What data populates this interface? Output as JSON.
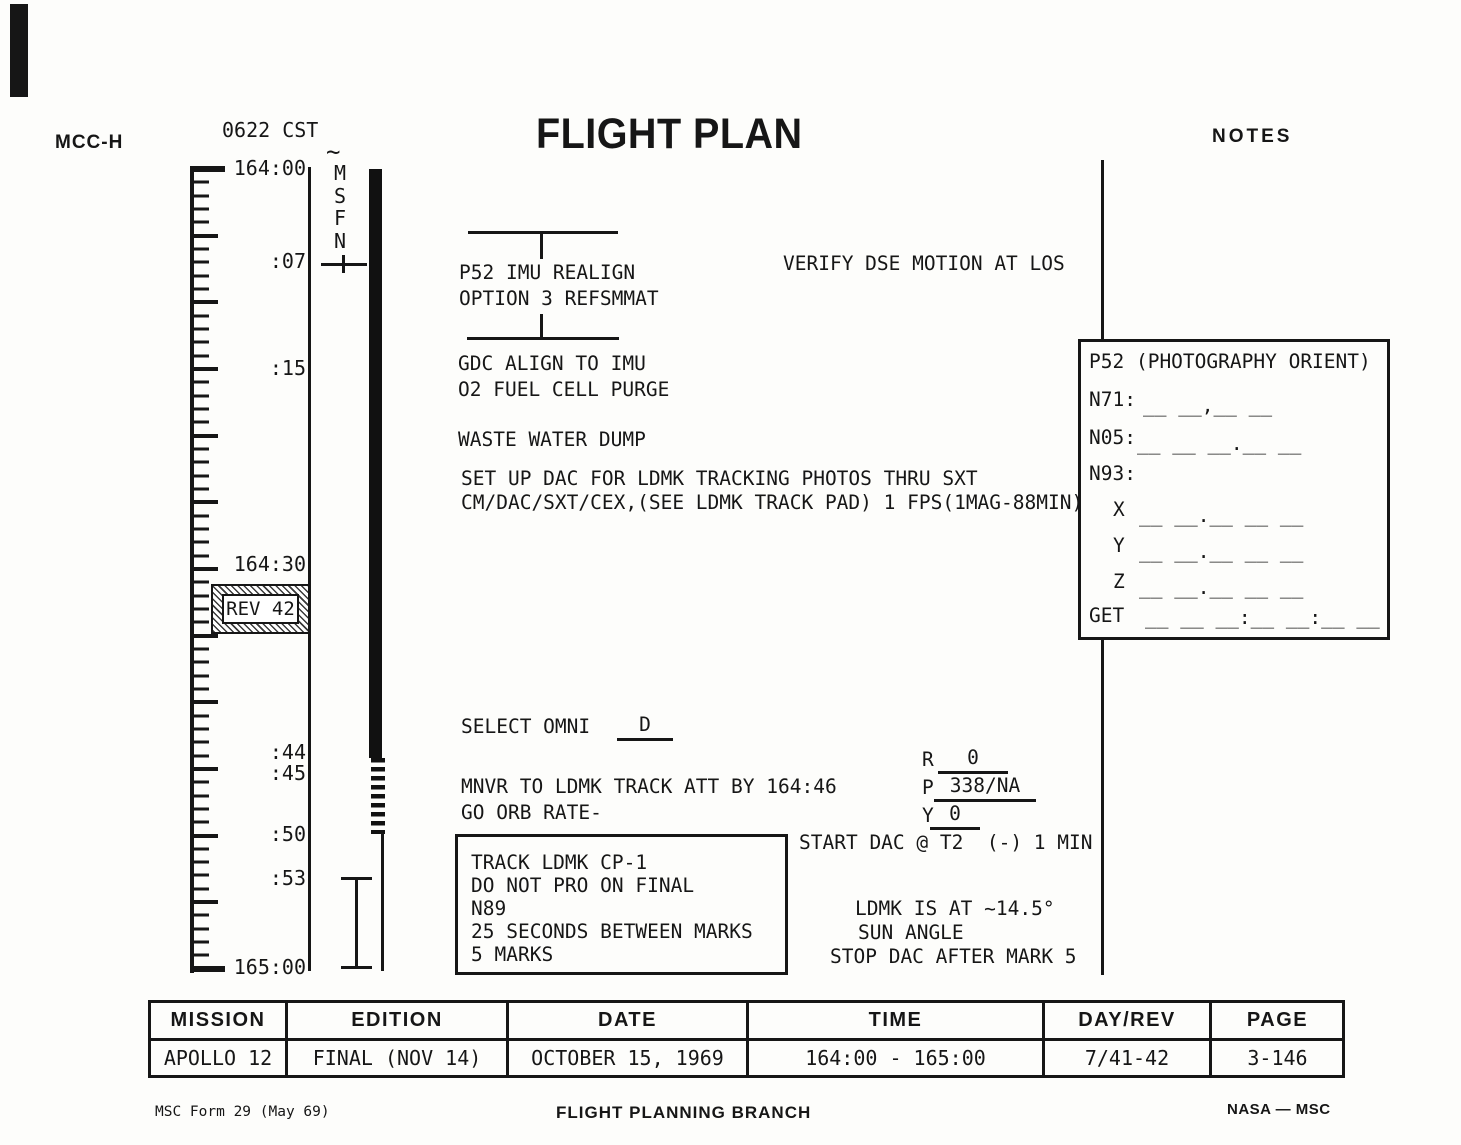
{
  "header": {
    "station": "MCC-H",
    "cst": "0622 CST",
    "title": "FLIGHT PLAN",
    "notes_label": "NOTES"
  },
  "timeline": {
    "start": "164:00",
    "end": "165:00",
    "marks": [
      {
        "label": ":07"
      },
      {
        "label": ":15"
      },
      {
        "label": "164:30"
      },
      {
        "label": ":44"
      },
      {
        "label": ":45"
      },
      {
        "label": ":50"
      },
      {
        "label": ":53"
      }
    ],
    "rev": "REV 42",
    "msfn": "M\nS\nF\nN",
    "tilde": "~"
  },
  "flightplan": {
    "p52_line1": "P52 IMU REALIGN",
    "p52_line2": "OPTION 3 REFSMMAT",
    "gdc": "GDC ALIGN TO IMU",
    "o2": "O2 FUEL CELL PURGE",
    "waste": "WASTE WATER DUMP",
    "dac1": "SET UP DAC FOR LDMK TRACKING PHOTOS THRU SXT",
    "dac2": "CM/DAC/SXT/CEX,(SEE LDMK TRACK PAD) 1 FPS(1MAG-88MIN)",
    "select_omni": "SELECT OMNI",
    "omni_value": "D",
    "mnvr": "MNVR TO LDMK TRACK ATT BY 164:46",
    "go_orb": "GO ORB RATE-",
    "att": [
      {
        "axis": "R",
        "value": "0"
      },
      {
        "axis": "P",
        "value": "338/NA"
      },
      {
        "axis": "Y",
        "value": "0"
      }
    ],
    "track_box": [
      {
        "line": "TRACK LDMK CP-1"
      },
      {
        "line": "DO NOT PRO ON FINAL"
      },
      {
        "line": "N89"
      },
      {
        "line": "25 SECONDS BETWEEN MARKS"
      },
      {
        "line": "5 MARKS"
      }
    ]
  },
  "notes": {
    "verify": "VERIFY DSE MOTION AT LOS",
    "p52_box": {
      "title": "P52 (PHOTOGRAPHY ORIENT)",
      "rows": [
        {
          "label": "N71:",
          "blank": "__ __,__ __"
        },
        {
          "label": "N05:",
          "blank": "__ __ __.__ __"
        },
        {
          "label": "N93:",
          "blank": ""
        },
        {
          "label": "X",
          "blank": "__ __.__ __ __"
        },
        {
          "label": "Y",
          "blank": "__ __.__ __ __"
        },
        {
          "label": "Z",
          "blank": "__ __.__ __ __"
        },
        {
          "label": "GET",
          "blank": "__ __ __:__ __:__ __"
        }
      ]
    },
    "start_dac": "START DAC @ T2  (-) 1 MIN",
    "ldmk1": "LDMK IS AT ~14.5°",
    "ldmk2": "SUN ANGLE",
    "stop_dac": "STOP DAC AFTER MARK 5"
  },
  "footer_table": {
    "columns": [
      {
        "header": "MISSION",
        "value": "APOLLO 12"
      },
      {
        "header": "EDITION",
        "value": "FINAL (NOV 14)"
      },
      {
        "header": "DATE",
        "value": "OCTOBER 15, 1969"
      },
      {
        "header": "TIME",
        "value": "164:00 - 165:00"
      },
      {
        "header": "DAY/REV",
        "value": "7/41-42"
      },
      {
        "header": "PAGE",
        "value": "3-146"
      }
    ]
  },
  "footer": {
    "form": "MSC Form 29 (May 69)",
    "branch": "FLIGHT PLANNING BRANCH",
    "agency": "NASA — MSC"
  }
}
